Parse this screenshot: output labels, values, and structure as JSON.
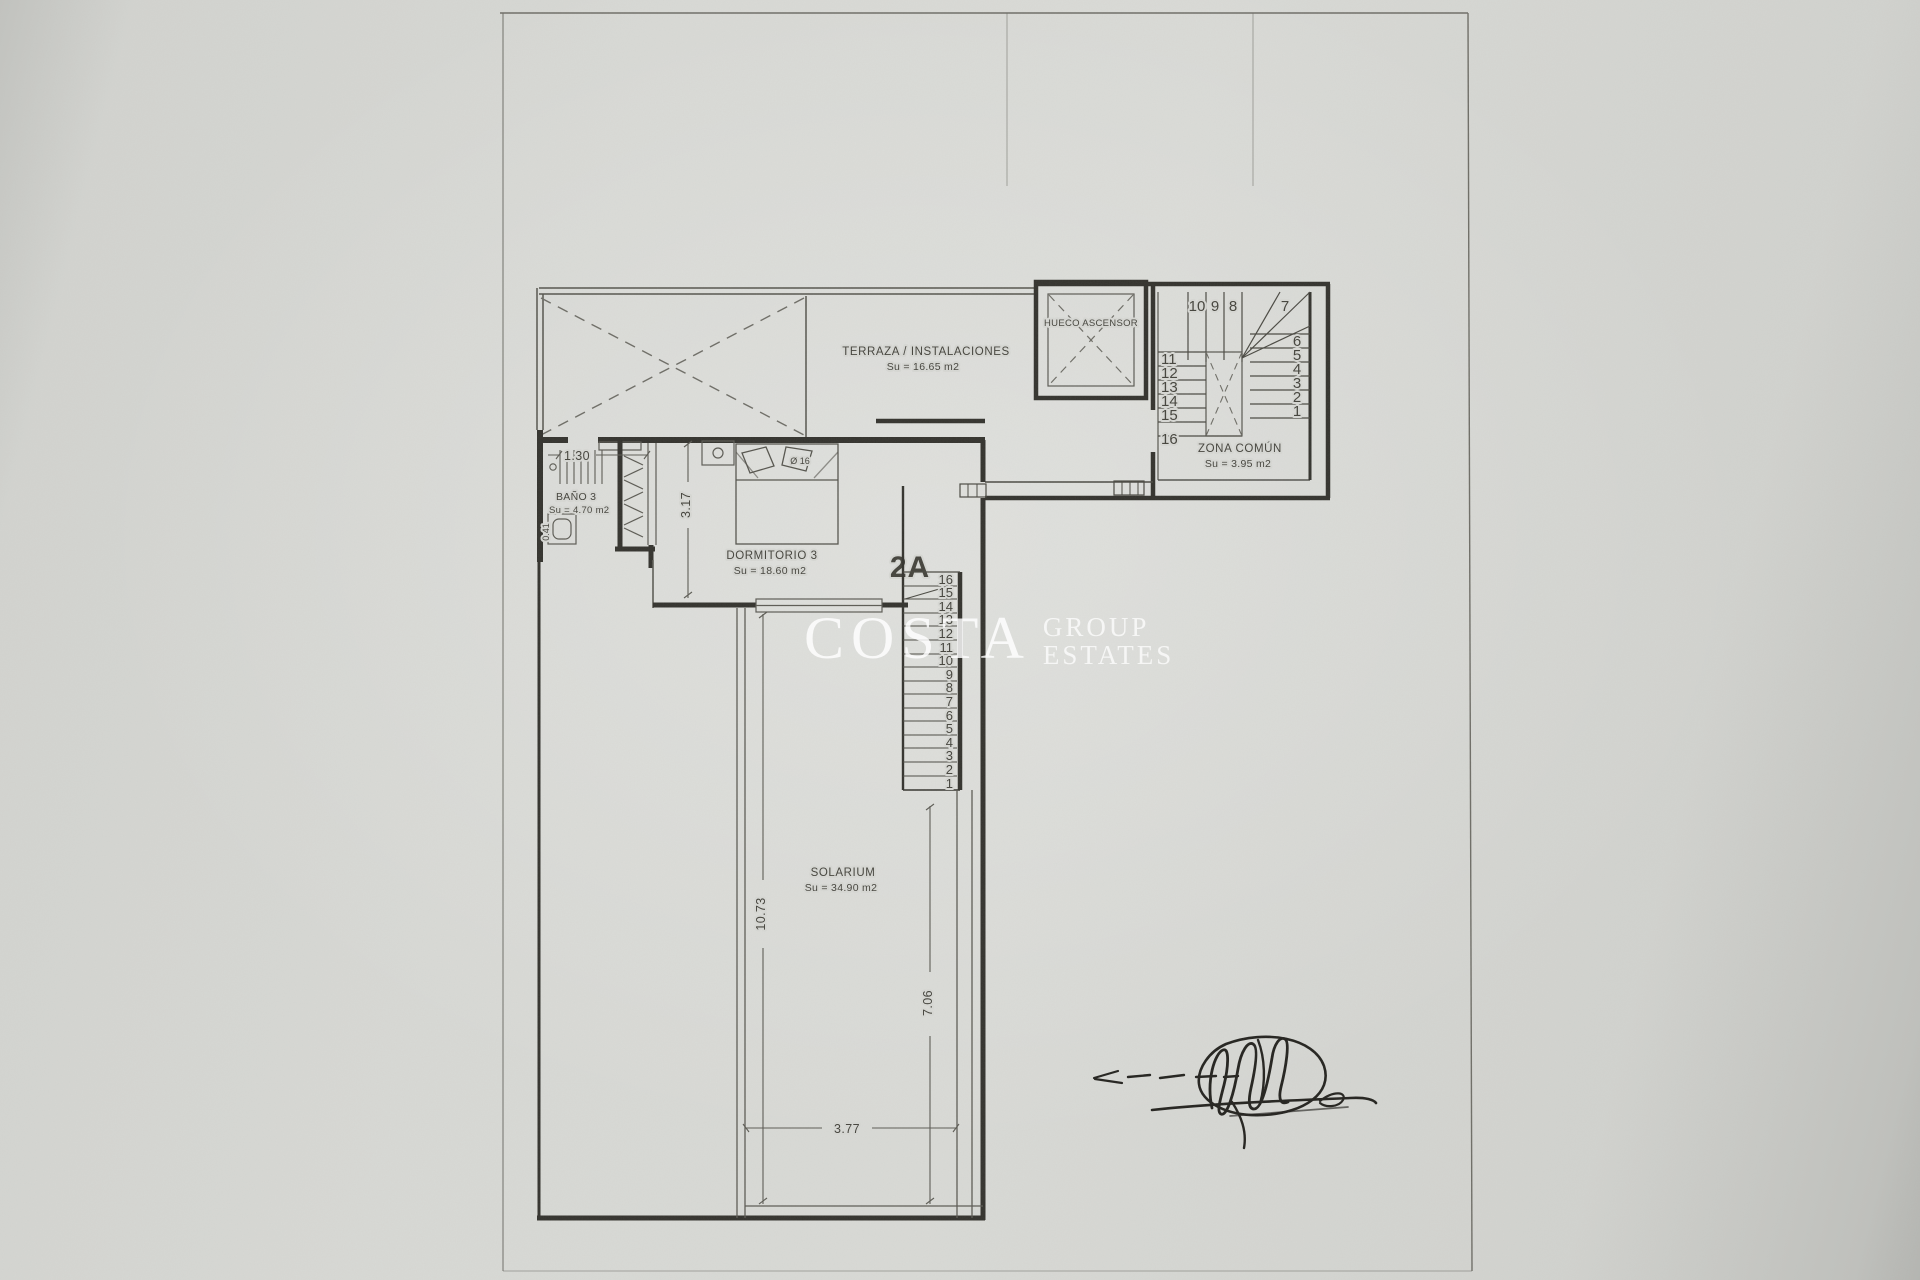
{
  "page": {
    "unit_label": "2A"
  },
  "rooms": {
    "terraza": {
      "label": "TERRAZA / INSTALACIONES",
      "area": "Su = 16.65 m2"
    },
    "ascensor": {
      "label": "HUECO ASCENSOR"
    },
    "zona_comun": {
      "label": "ZONA COMÚN",
      "area": "Su = 3.95 m2"
    },
    "bano": {
      "label": "BAÑO 3",
      "area": "Su = 4.70 m2"
    },
    "dormitorio": {
      "label": "DORMITORIO 3",
      "area": "Su = 18.60 m2"
    },
    "solarium": {
      "label": "SOLARIUM",
      "area": "Su = 34.90 m2"
    }
  },
  "dimensions": {
    "bath_width": "1.30",
    "bath_side": "0.41",
    "bedroom_depth": "3.17",
    "bed_width": "Ø 16",
    "solarium_length": "10.73",
    "solarium_right": "7.06",
    "solarium_width": "3.77"
  },
  "stairs": {
    "communal": {
      "top": [
        "10",
        "9",
        "8"
      ],
      "corner": "7",
      "right": [
        "6",
        "5",
        "4",
        "3",
        "2",
        "1"
      ],
      "left": [
        "11",
        "12",
        "13",
        "14",
        "15",
        "16"
      ]
    },
    "apartment": {
      "numbers": [
        "16",
        "15",
        "14",
        "13",
        "12",
        "11",
        "10",
        "9",
        "8",
        "7",
        "6",
        "5",
        "4",
        "3",
        "2",
        "1"
      ]
    }
  },
  "watermark": {
    "name": "COSTA",
    "line1": "GROUP",
    "line2": "ESTATES"
  },
  "colors": {
    "paper": "#d6d7d3",
    "ink": "#33322d",
    "watermark": "#ffffff"
  }
}
